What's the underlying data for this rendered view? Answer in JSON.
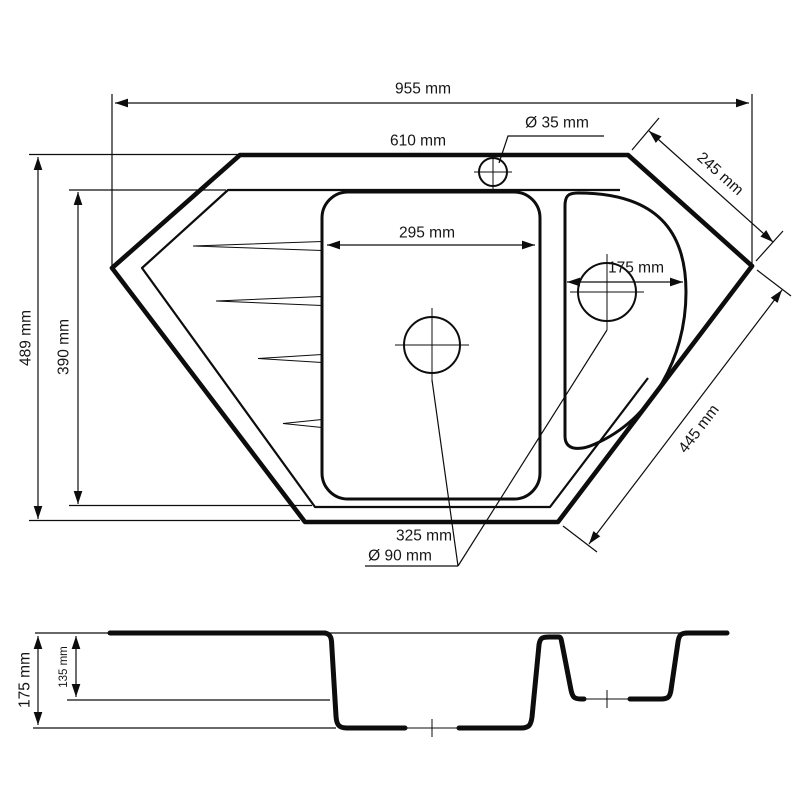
{
  "diagram": {
    "type": "technical-drawing",
    "subject": "corner kitchen sink with one and a half bowls, plan view and section view",
    "line_color": "#0d0d0d",
    "background": "#ffffff",
    "top_view": {
      "overall_width": "955 mm",
      "top_edge_width": "610 mm",
      "faucet_hole_diameter": "Ø 35 mm",
      "upper_right_edge": "245 mm",
      "overall_depth": "489 mm",
      "rim_inner_depth": "390 mm",
      "main_bowl_width": "295 mm",
      "small_bowl_width": "175 mm",
      "lower_right_edge": "445 mm",
      "bottom_edge_width": "325 mm",
      "drain_diameter": "Ø 90 mm"
    },
    "section_view": {
      "main_bowl_depth": "175 mm",
      "small_bowl_depth": "135 mm"
    }
  }
}
